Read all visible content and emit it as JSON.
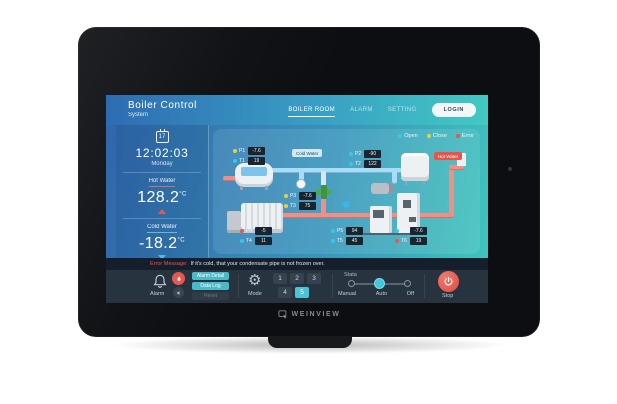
{
  "device": {
    "brand": "WEINVIEW"
  },
  "header": {
    "title": "Boiler Control",
    "subtitle": "System",
    "nav": [
      {
        "label": "BOILER ROOM",
        "active": true
      },
      {
        "label": "ALARM",
        "active": false
      },
      {
        "label": "SETTING",
        "active": false
      }
    ],
    "login_label": "LOGIN"
  },
  "sidebar": {
    "date_day": "17",
    "time": "12:02:03",
    "weekday": "Monday",
    "hot_water": {
      "label": "Hot Water",
      "value": "128.2",
      "unit": "°C",
      "trend": "up"
    },
    "cold_water": {
      "label": "Cold Water",
      "value": "-18.2",
      "unit": "°C",
      "trend": "down"
    }
  },
  "diagram": {
    "legend": [
      {
        "label": "Open",
        "color": "#38c8e8"
      },
      {
        "label": "Close",
        "color": "#e4d23c"
      },
      {
        "label": "Error",
        "color": "#e8564e"
      }
    ],
    "pipe_labels": {
      "cold": "Cold Water",
      "hot": "Hot Water"
    },
    "sensors": [
      {
        "rows": [
          {
            "label": "P1",
            "value": "-7.6",
            "status": "close"
          },
          {
            "label": "T1",
            "value": "19",
            "status": "open"
          }
        ]
      },
      {
        "rows": [
          {
            "label": "P2",
            "value": "-90",
            "status": "open"
          },
          {
            "label": "T2",
            "value": "122",
            "status": "open"
          }
        ]
      },
      {
        "rows": [
          {
            "label": "P3",
            "value": "-7.6",
            "status": "close"
          },
          {
            "label": "T3",
            "value": "75",
            "status": "close"
          }
        ]
      },
      {
        "rows": [
          {
            "label": "P4",
            "value": "-5",
            "status": "error"
          },
          {
            "label": "T4",
            "value": "11",
            "status": "open"
          }
        ]
      },
      {
        "rows": [
          {
            "label": "P5",
            "value": "94",
            "status": "open"
          },
          {
            "label": "T5",
            "value": "45",
            "status": "open"
          }
        ]
      },
      {
        "rows": [
          {
            "label": "P6",
            "value": "-7.6",
            "status": "open"
          },
          {
            "label": "T6",
            "value": "19",
            "status": "error"
          }
        ]
      }
    ]
  },
  "alerts": {
    "error_label": "Error Message:",
    "error_text": "If it's cold, that your condensate pipe is not frozen over."
  },
  "controls": {
    "alarm_label": "Alarm",
    "buttons": [
      {
        "label": "Alarm Detail"
      },
      {
        "label": "Data Log"
      },
      {
        "label": "Reset"
      }
    ],
    "mode_label": "Mode",
    "mode_numbers": [
      "1",
      "2",
      "3",
      "4",
      "5"
    ],
    "mode_selected": "5",
    "state_label": "Stata",
    "state_options": [
      "Manual",
      "Auto",
      "Off"
    ],
    "state_selected": "Auto",
    "stop_label": "Stop"
  },
  "colors": {
    "open": "#38c8e8",
    "close": "#e4d23c",
    "error": "#e8564e",
    "accent_teal": "#4cb9c9",
    "accent_cyan": "#4cc3d6",
    "stop_red": "#e8564e",
    "header_gradient_start": "#2e6cb2",
    "header_gradient_end": "#41c9c3",
    "hot_pipe": "#ef8f86",
    "cold_pipe": "#a9dcf5"
  }
}
